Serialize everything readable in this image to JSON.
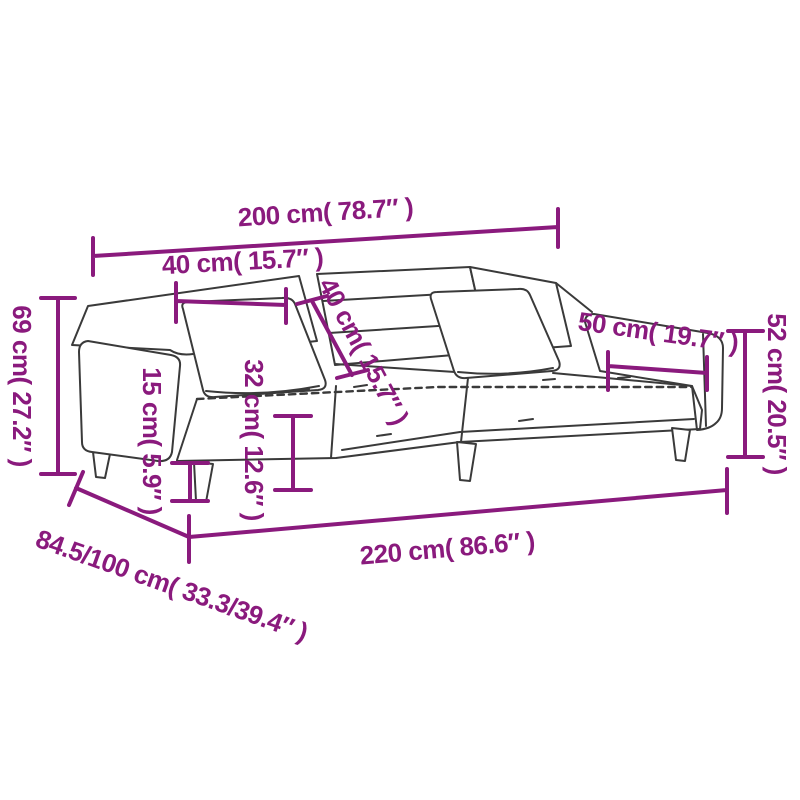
{
  "page": {
    "background_color": "#ffffff"
  },
  "style": {
    "dimension_color": "#8a1a7d",
    "outline_color": "#3a3a3a"
  },
  "figure": {
    "type": "product-dimension-diagram",
    "subject": "sofa bed with two pillows, three-quarter perspective line drawing"
  },
  "dimension_labels": {
    "top_200": "200 cm( 78.7″ )",
    "top_40": "40 cm( 15.7″ )",
    "diag_40": "40 cm( 15.7″ )",
    "mid_32": "32 cm( 12.6″ )",
    "left_15": "15 cm( 5.9″ )",
    "left_69": "69 cm( 27.2″ )",
    "right_52": "52 cm( 20.5″ )",
    "right_50": "50 cm( 19.7″ )",
    "bottom_220": "220 cm( 86.6″ )",
    "bottom_depth": "84.5/100 cm( 33.3/39.4″ )"
  }
}
